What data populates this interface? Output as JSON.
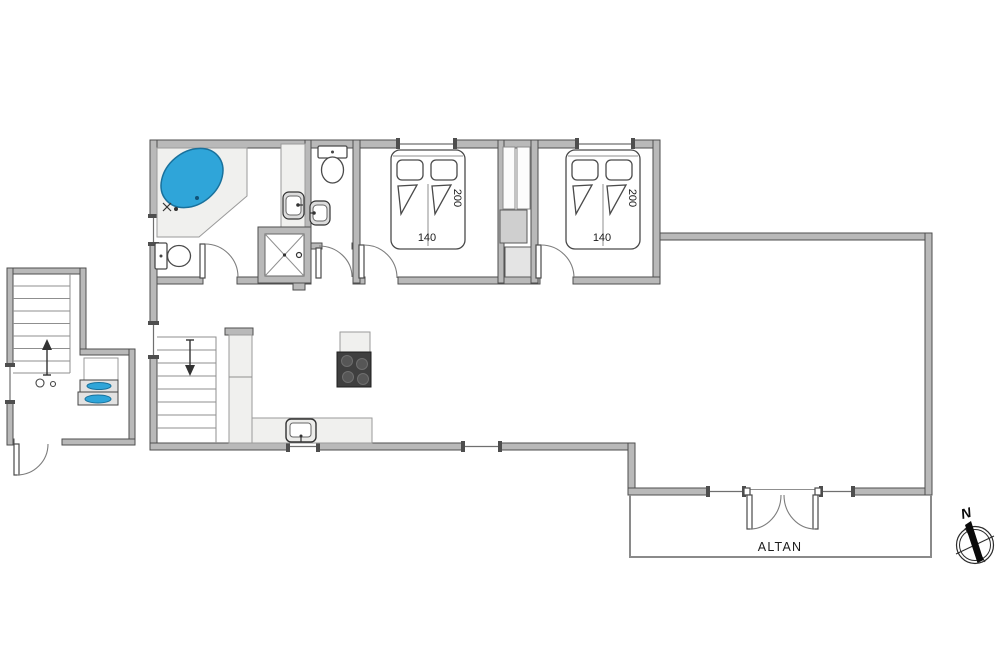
{
  "floorplan": {
    "bedroom1": {
      "bed_width_label": "140",
      "bed_length_label": "200"
    },
    "bedroom2": {
      "bed_width_label": "140",
      "bed_length_label": "200"
    },
    "balcony": {
      "label": "ALTAN"
    },
    "compass": {
      "north_label": "N"
    },
    "colors": {
      "wall_fill": "#b9b9b9",
      "wall_outline": "#4e4e4e",
      "counter_fill": "#f0f0ee",
      "tub_blue": "#2fa5d9",
      "cooktop_black": "#3f3f3f",
      "background": "#ffffff"
    }
  }
}
